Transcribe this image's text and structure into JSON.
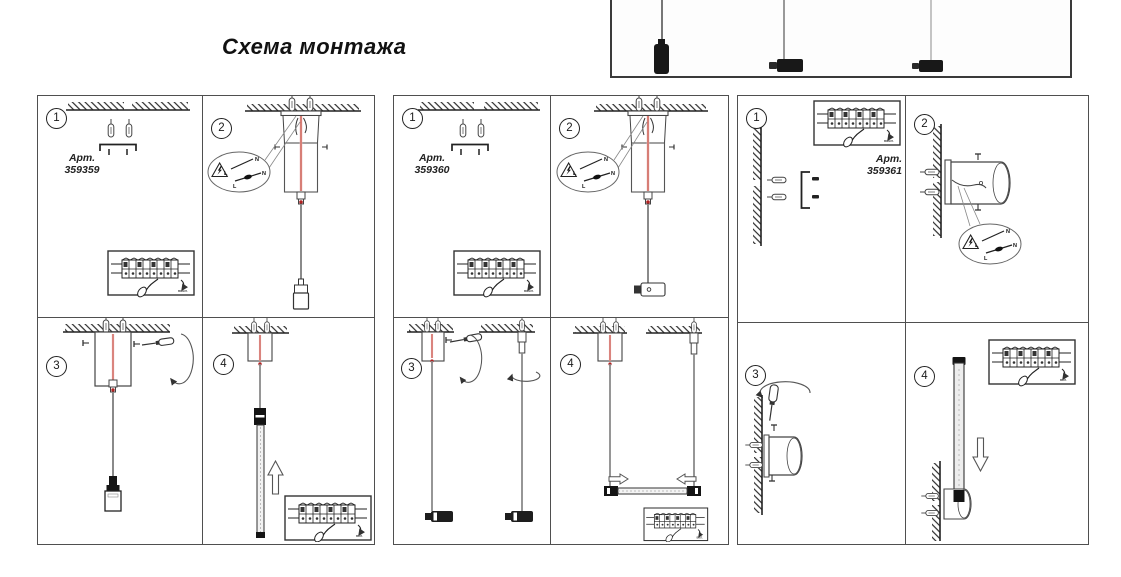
{
  "header": {
    "title": "Схема монтажа"
  },
  "wiring": {
    "neutral": "N",
    "live": "L"
  },
  "insets": {
    "power_off": "выкл.",
    "power_on": "вкл."
  },
  "panels": [
    {
      "article_label": "Арт.",
      "article_number": "359359",
      "steps": [
        "1",
        "2",
        "3",
        "4"
      ]
    },
    {
      "article_label": "Арт.",
      "article_number": "359360",
      "steps": [
        "1",
        "2",
        "3",
        "4"
      ]
    },
    {
      "article_label": "Арт.",
      "article_number": "359361",
      "steps": [
        "1",
        "2",
        "3",
        "4"
      ]
    }
  ]
}
